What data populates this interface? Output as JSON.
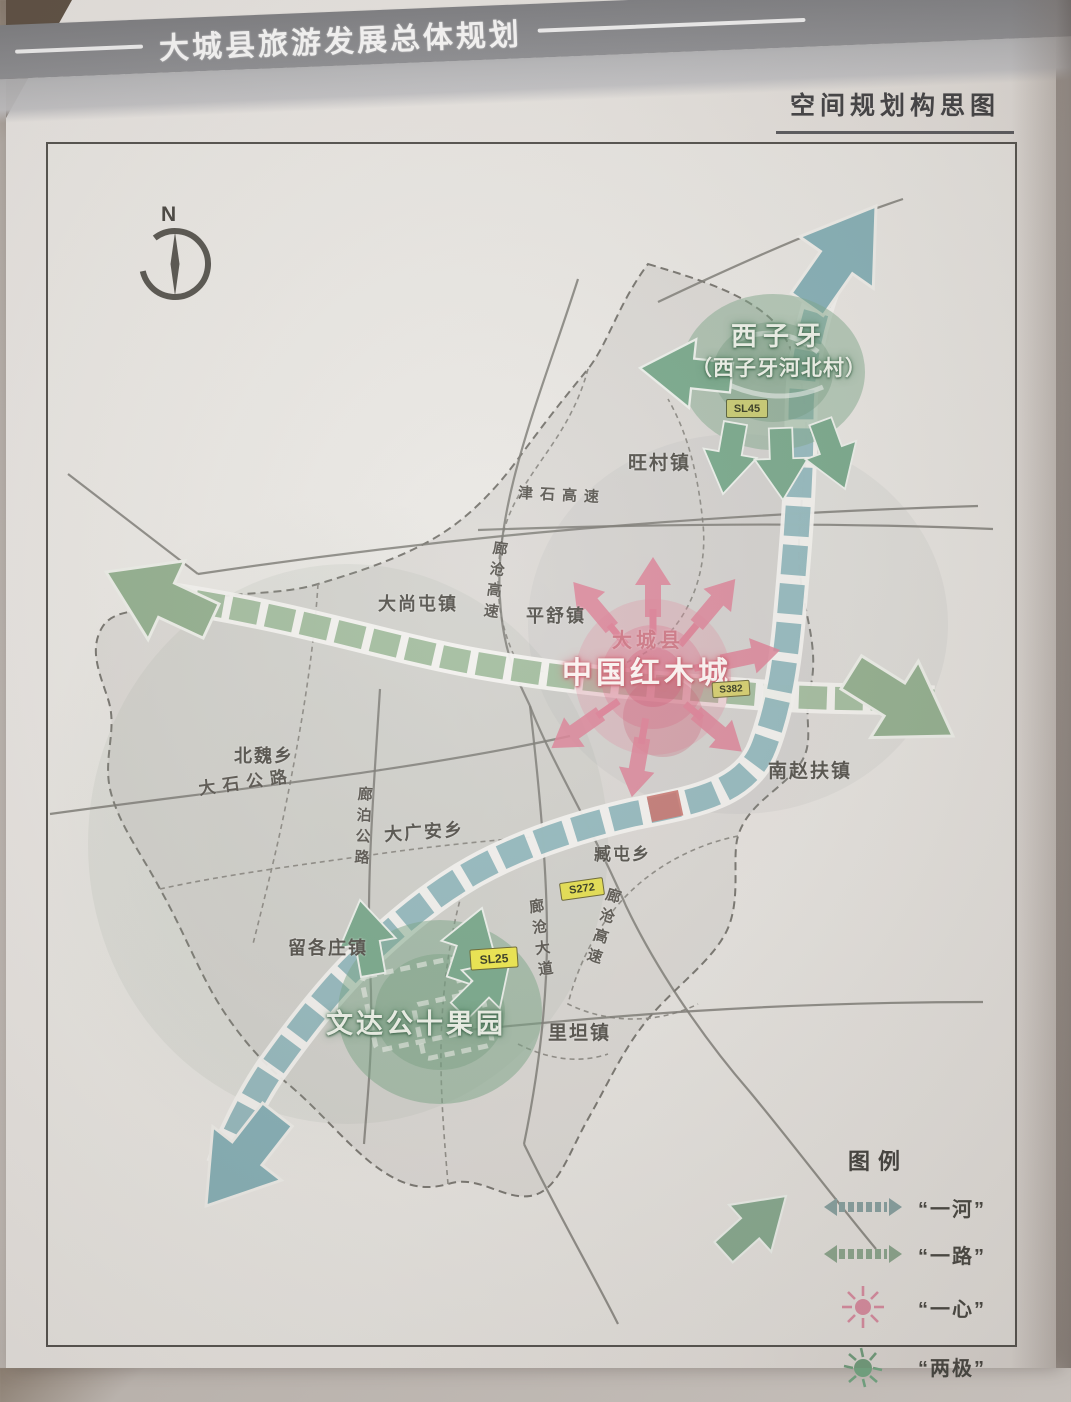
{
  "header": {
    "title": "大城县旅游发展总体规划",
    "subtitle": "空间规划构思图"
  },
  "compass": {
    "north_label": "N"
  },
  "map": {
    "poles": {
      "xiziya": {
        "title": "西子牙",
        "subtitle": "（西子牙河北村）"
      },
      "wendagong": {
        "title": "文达公十果园"
      }
    },
    "center": {
      "county_label": "大城县",
      "title": "中国红木城"
    },
    "towns": {
      "wangcun": "旺村镇",
      "dashangtun": "大尚屯镇",
      "pingshu": "平舒镇",
      "beiwei": "北魏乡",
      "daguangan": "大广安乡",
      "nanzhaofu": "南赵扶镇",
      "zangtun": "臧屯乡",
      "liugezhuang": "留各庄镇",
      "litan": "里坦镇"
    },
    "roads": {
      "jinshi": "津石高速",
      "langcang_n": "廊沧高速",
      "langcang_s": "廊沧高速",
      "langcang_ave": "廊沧大道",
      "langbo": "廊泊公路",
      "dashi": "大石公路"
    },
    "badges": {
      "sl45": "SL45",
      "s382": "S382",
      "s272": "S272",
      "sl25": "SL25"
    }
  },
  "legend": {
    "title": "图例",
    "items": [
      {
        "label": "“一河”"
      },
      {
        "label": "“一路”"
      },
      {
        "label": "“一心”"
      },
      {
        "label": "“两极”"
      }
    ]
  },
  "colors": {
    "river_chain": "#8fb6bc",
    "road_chain": "#9fba9b",
    "center_core": "#dd8398",
    "poles_green": "#79a98c",
    "badge_yellow": "#e9e24f",
    "header_band": "#8e8f93"
  }
}
